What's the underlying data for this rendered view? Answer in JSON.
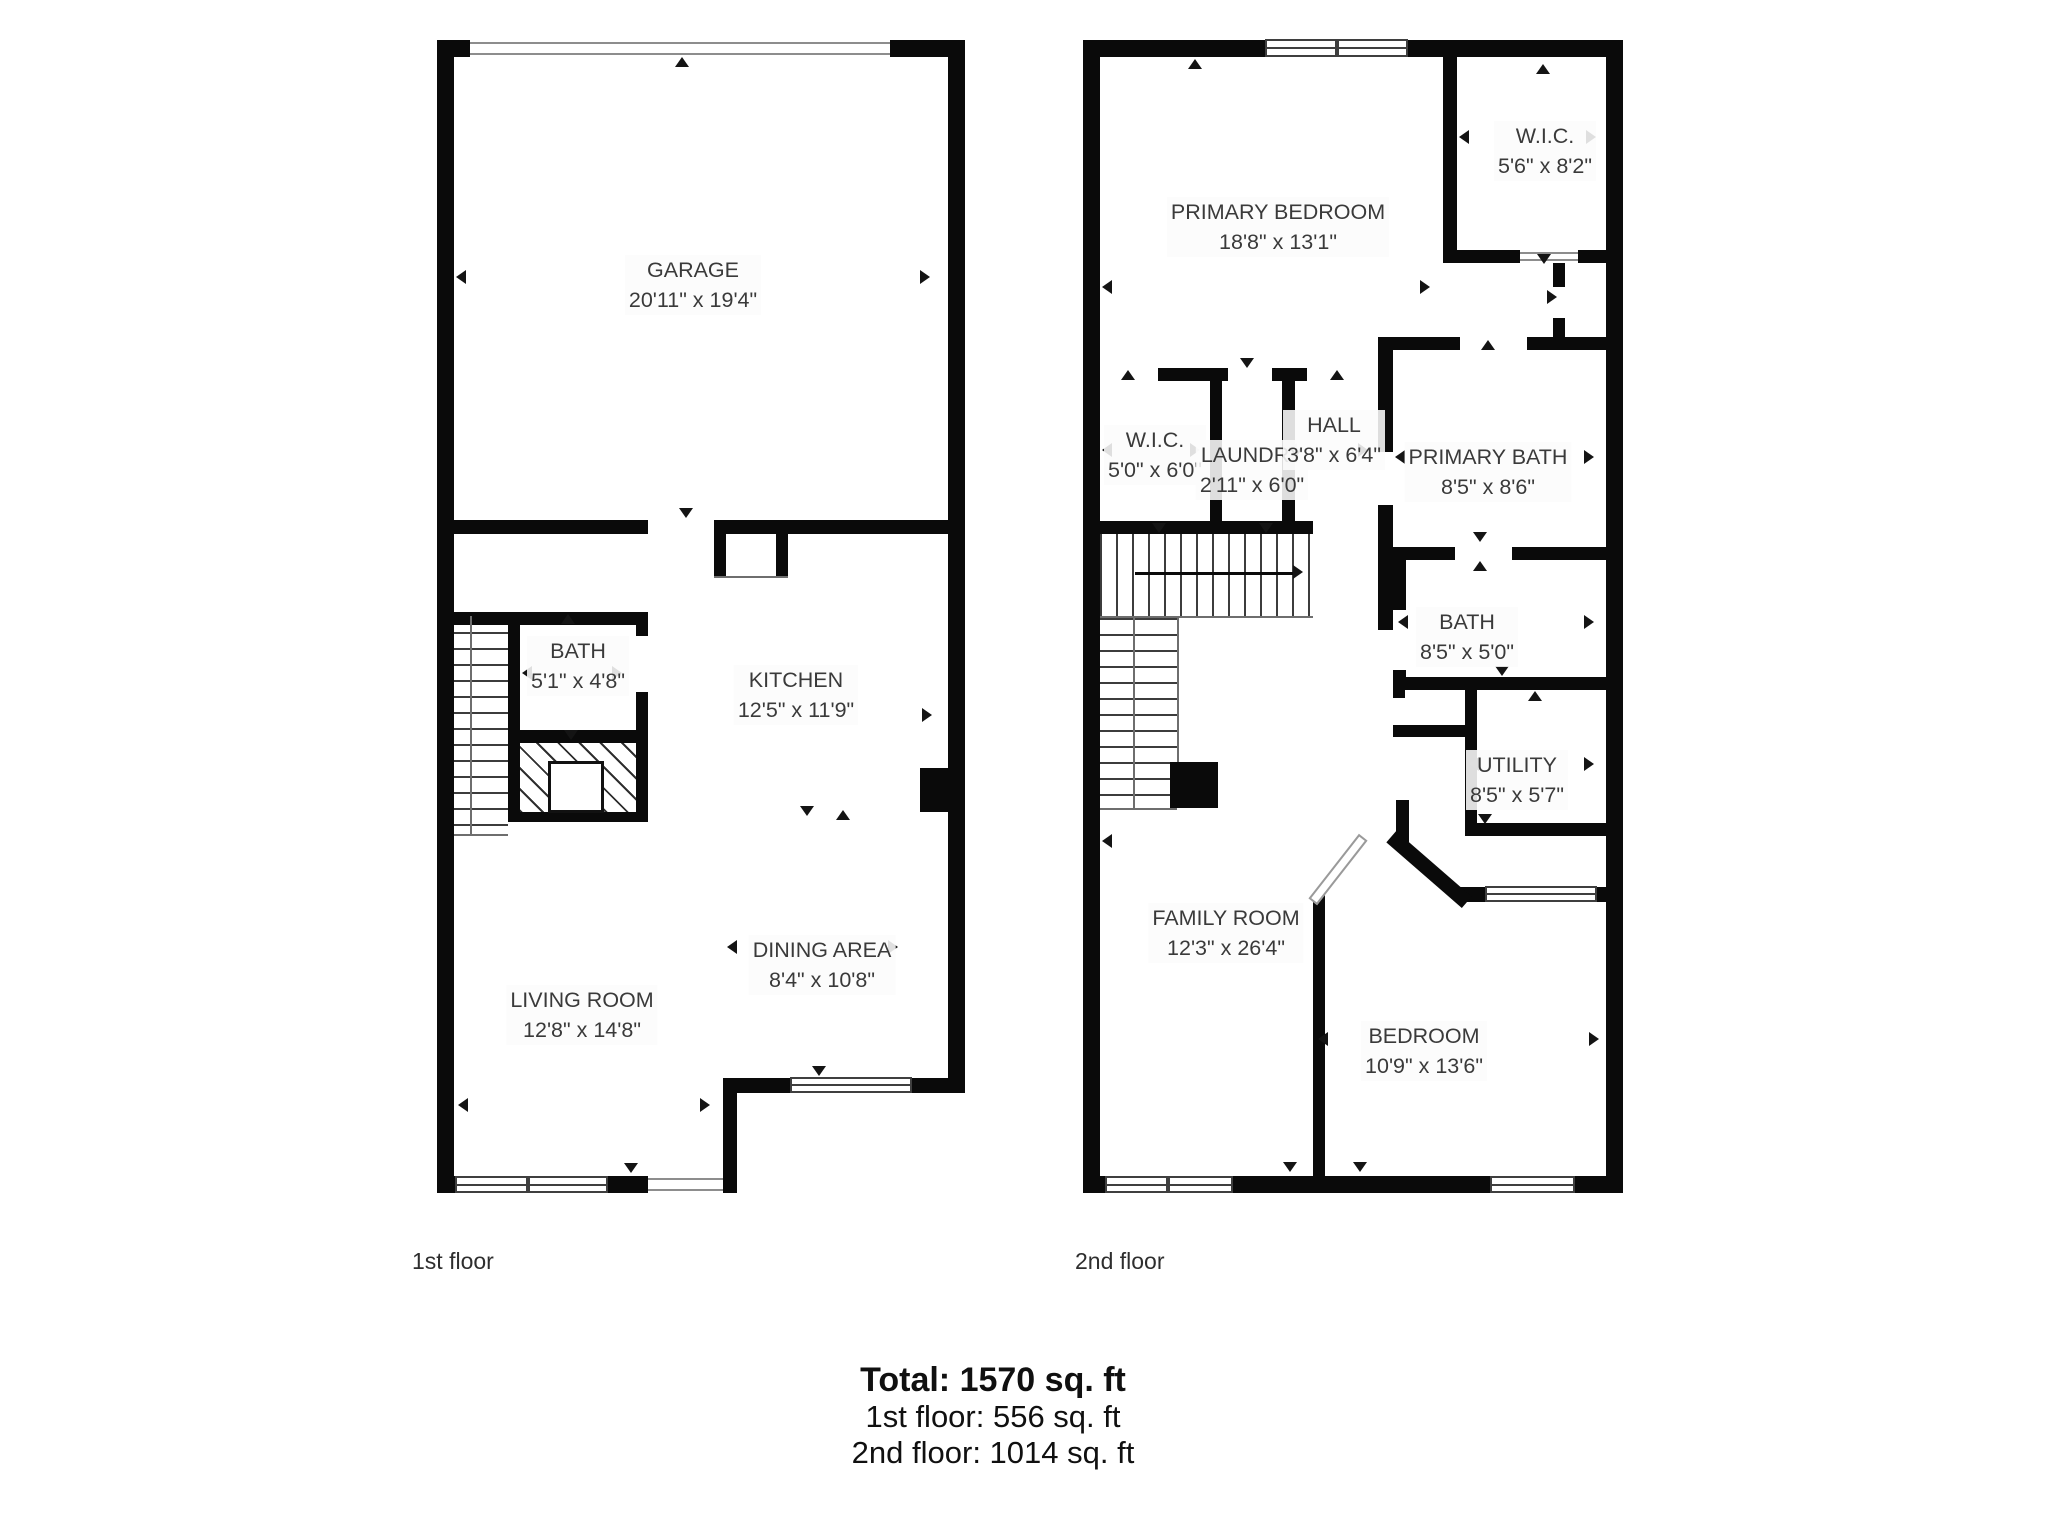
{
  "page": {
    "background_color": "#ffffff",
    "wall_color": "#0a0a0a",
    "text_color": "#3a3a3a"
  },
  "floor1": {
    "caption": "1st floor",
    "rooms": {
      "garage": {
        "name": "GARAGE",
        "dims": "20'11\" x 19'4\""
      },
      "bath": {
        "name": "BATH",
        "dims": "5'1\" x 4'8\""
      },
      "kitchen": {
        "name": "KITCHEN",
        "dims": "12'5\" x 11'9\""
      },
      "living_room": {
        "name": "LIVING ROOM",
        "dims": "12'8\" x 14'8\""
      },
      "dining_area": {
        "name": "DINING AREA",
        "dims": "8'4\" x 10'8\""
      }
    }
  },
  "floor2": {
    "caption": "2nd floor",
    "rooms": {
      "primary_bedroom": {
        "name": "PRIMARY BEDROOM",
        "dims": "18'8\" x 13'1\""
      },
      "wic_upper": {
        "name": "W.I.C.",
        "dims": "5'6\" x 8'2\""
      },
      "wic_lower": {
        "name": "W.I.C.",
        "dims": "5'0\" x 6'0\""
      },
      "laundry": {
        "name": "LAUNDRY",
        "dims": "2'11\" x 6'0\""
      },
      "hall": {
        "name": "HALL",
        "dims": "3'8\" x 6'4\""
      },
      "primary_bath": {
        "name": "PRIMARY BATH",
        "dims": "8'5\" x 8'6\""
      },
      "bath": {
        "name": "BATH",
        "dims": "8'5\" x 5'0\""
      },
      "utility": {
        "name": "UTILITY",
        "dims": "8'5\" x 5'7\""
      },
      "family_room": {
        "name": "FAMILY ROOM",
        "dims": "12'3\" x 26'4\""
      },
      "bedroom": {
        "name": "BEDROOM",
        "dims": "10'9\" x 13'6\""
      }
    }
  },
  "summary": {
    "total": "Total: 1570 sq. ft",
    "floor1": "1st floor: 556 sq. ft",
    "floor2": "2nd floor: 1014 sq. ft"
  }
}
